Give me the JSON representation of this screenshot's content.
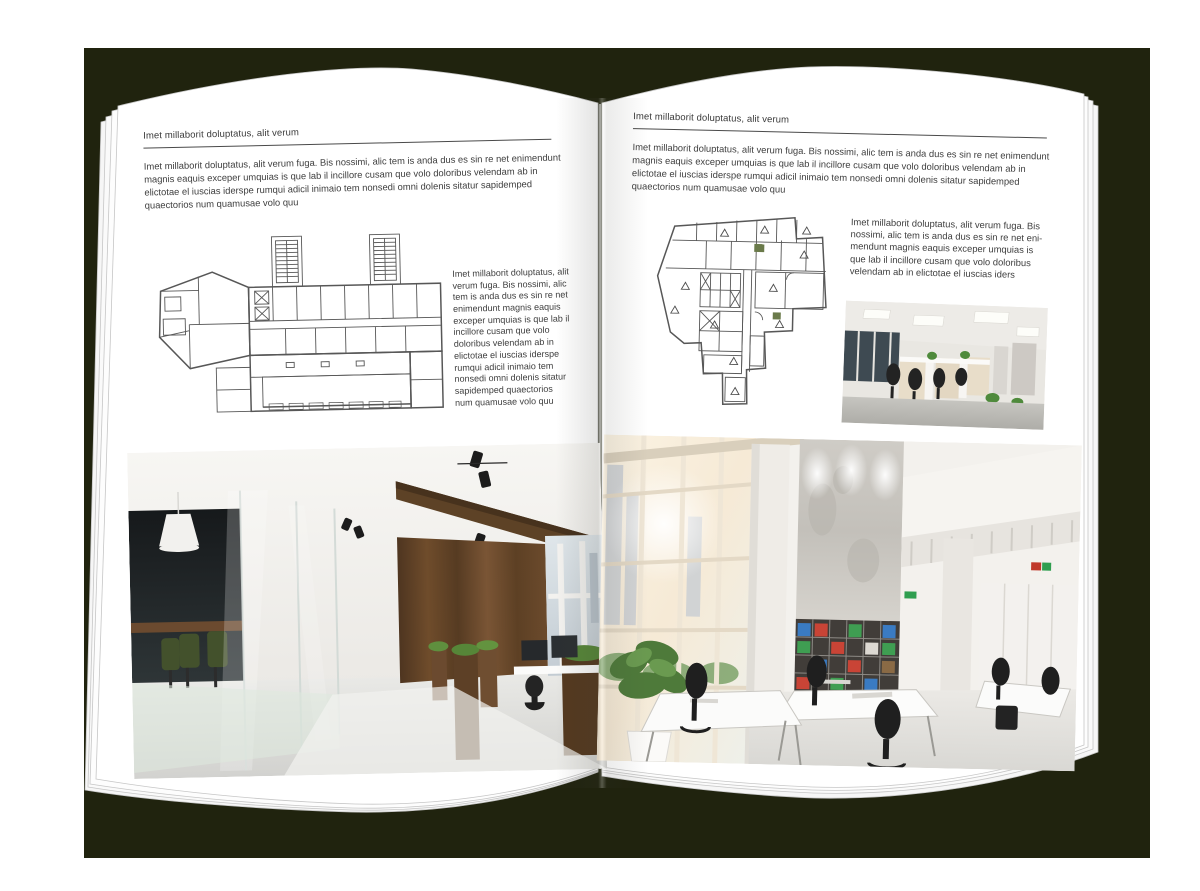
{
  "book": {
    "cover_color": "#20230e",
    "paper_color": "#ffffff",
    "ink_color": "#3f3f3f"
  },
  "left_page": {
    "header": "Imet millaborit doluptatus, alit verum",
    "intro": "Imet millaborit doluptatus, alit verum fuga. Bis nossimi, alic tem is anda dus es sin re net enimendunt magnis eaquis exceper umquias is que lab il incillore cusam que volo doloribus velendam ab in elictotae el iuscias iderspe rumqui adicil inimaio tem nonsedi omni dolenis sitatur sapidemped quaectorios num quamusae volo quu",
    "side_text": "Imet millaborit doluptatus, alit verum fuga. Bis nossimi, alic tem is anda dus es sin re net enimendunt magnis eaquis exceper umquias is que lab il incillore cusam que volo doloribus velendam ab in elictotae el iuscias iderspe rumqui adicil inimaio tem nonsedi omni dolenis sitatur sapidemped quaectorios num quamusae volo quu"
  },
  "right_page": {
    "header": "Imet millaborit doluptatus, alit verum",
    "intro": "Imet millaborit doluptatus, alit verum fuga. Bis nossimi, alic tem is anda dus es sin re net enimendunt magnis eaquis exceper umquias is que lab il incillore cusam que volo doloribus velendam ab in elictotae el iuscias iderspe rumqui adicil inimaio tem nonsedi omni dolenis sitatur sapidemped quaectorios num quamusae volo quu",
    "side_text": "Imet millaborit doluptatus, alit verum fuga. Bis nossimi, alic tem is anda dus es sin re net eni-mendunt magnis eaquis exceper umquias is que lab il incillore cusam que volo doloribus velendam ab in elictotae el iuscias iders"
  }
}
